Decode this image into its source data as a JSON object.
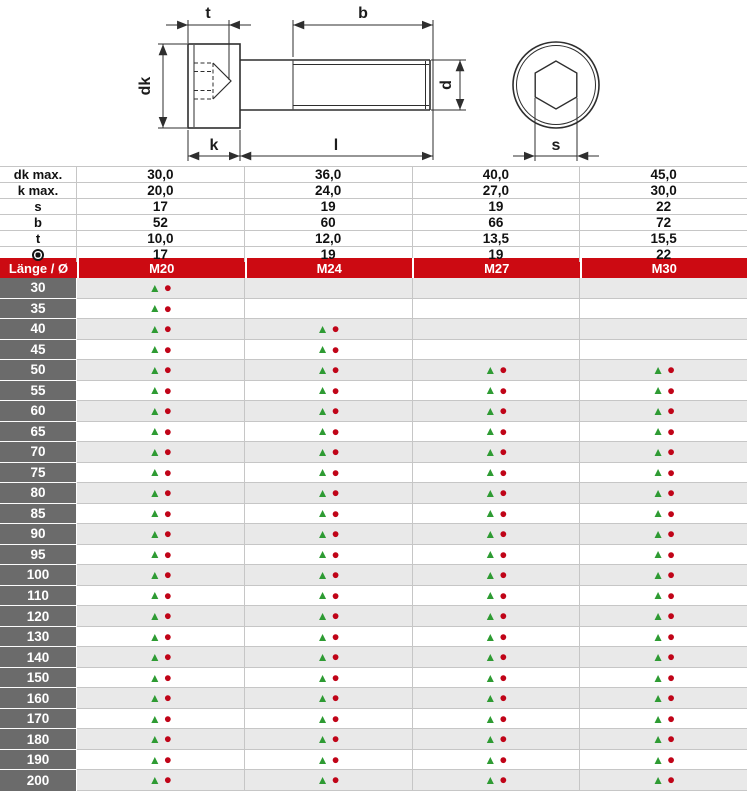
{
  "drawing": {
    "dimension_labels": {
      "t": "t",
      "b": "b",
      "dk": "dk",
      "k": "k",
      "l": "l",
      "d": "d",
      "s": "s"
    }
  },
  "spec": {
    "rows": [
      {
        "label": "dk max.",
        "icon": null,
        "values": [
          "30,0",
          "36,0",
          "40,0",
          "45,0"
        ]
      },
      {
        "label": "k max.",
        "icon": null,
        "values": [
          "20,0",
          "24,0",
          "27,0",
          "30,0"
        ]
      },
      {
        "label": "s",
        "icon": null,
        "values": [
          "17",
          "19",
          "19",
          "22"
        ]
      },
      {
        "label": "b",
        "icon": null,
        "values": [
          "52",
          "60",
          "66",
          "72"
        ]
      },
      {
        "label": "t",
        "icon": null,
        "values": [
          "10,0",
          "12,0",
          "13,5",
          "15,5"
        ]
      },
      {
        "label": "",
        "icon": "bullseye-icon",
        "values": [
          "17",
          "19",
          "19",
          "22"
        ]
      }
    ]
  },
  "header": {
    "length_label": "Länge / Ø",
    "sizes": [
      "M20",
      "M24",
      "M27",
      "M30"
    ]
  },
  "lengths": [
    {
      "length": "30",
      "availability": [
        true,
        false,
        false,
        false
      ]
    },
    {
      "length": "35",
      "availability": [
        true,
        false,
        false,
        false
      ]
    },
    {
      "length": "40",
      "availability": [
        true,
        true,
        false,
        false
      ]
    },
    {
      "length": "45",
      "availability": [
        true,
        true,
        false,
        false
      ]
    },
    {
      "length": "50",
      "availability": [
        true,
        true,
        true,
        true
      ]
    },
    {
      "length": "55",
      "availability": [
        true,
        true,
        true,
        true
      ]
    },
    {
      "length": "60",
      "availability": [
        true,
        true,
        true,
        true
      ]
    },
    {
      "length": "65",
      "availability": [
        true,
        true,
        true,
        true
      ]
    },
    {
      "length": "70",
      "availability": [
        true,
        true,
        true,
        true
      ]
    },
    {
      "length": "75",
      "availability": [
        true,
        true,
        true,
        true
      ]
    },
    {
      "length": "80",
      "availability": [
        true,
        true,
        true,
        true
      ]
    },
    {
      "length": "85",
      "availability": [
        true,
        true,
        true,
        true
      ]
    },
    {
      "length": "90",
      "availability": [
        true,
        true,
        true,
        true
      ]
    },
    {
      "length": "95",
      "availability": [
        true,
        true,
        true,
        true
      ]
    },
    {
      "length": "100",
      "availability": [
        true,
        true,
        true,
        true
      ]
    },
    {
      "length": "110",
      "availability": [
        true,
        true,
        true,
        true
      ]
    },
    {
      "length": "120",
      "availability": [
        true,
        true,
        true,
        true
      ]
    },
    {
      "length": "130",
      "availability": [
        true,
        true,
        true,
        true
      ]
    },
    {
      "length": "140",
      "availability": [
        true,
        true,
        true,
        true
      ]
    },
    {
      "length": "150",
      "availability": [
        true,
        true,
        true,
        true
      ]
    },
    {
      "length": "160",
      "availability": [
        true,
        true,
        true,
        true
      ]
    },
    {
      "length": "170",
      "availability": [
        true,
        true,
        true,
        true
      ]
    },
    {
      "length": "180",
      "availability": [
        true,
        true,
        true,
        true
      ]
    },
    {
      "length": "190",
      "availability": [
        true,
        true,
        true,
        true
      ]
    },
    {
      "length": "200",
      "availability": [
        true,
        true,
        true,
        true
      ]
    }
  ],
  "markers": {
    "triangle": "▲",
    "circle": "●"
  },
  "colors": {
    "header_red": "#cc0a12",
    "length_cell_gray": "#6b6b6b",
    "row_alt_gray": "#e9e9e9",
    "grid_line": "#c6c6c6",
    "marker_green": "#2e9b33",
    "marker_red": "#c00418",
    "drawing_line": "#2e2e2e"
  }
}
